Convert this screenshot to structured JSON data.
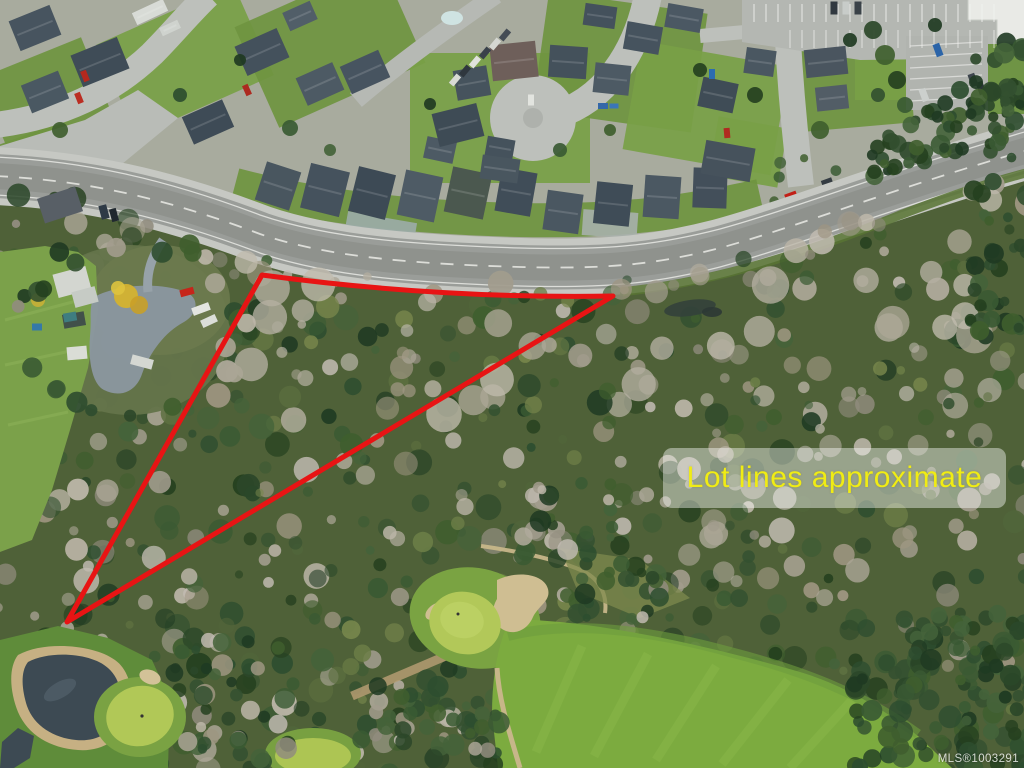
{
  "photo": {
    "label": "Lot lines approximate",
    "watermark": "MLS®1003291"
  },
  "lot_outline": {
    "path": "M 262,275 Q 440,299 613,296 L 67,622 Z"
  },
  "colors": {
    "lot-outline": "#e81414",
    "label-text": "#f0ec14",
    "label-bg": "rgba(255,255,255,0.42)",
    "watermark-text": "rgba(242,244,240,0.85)"
  }
}
